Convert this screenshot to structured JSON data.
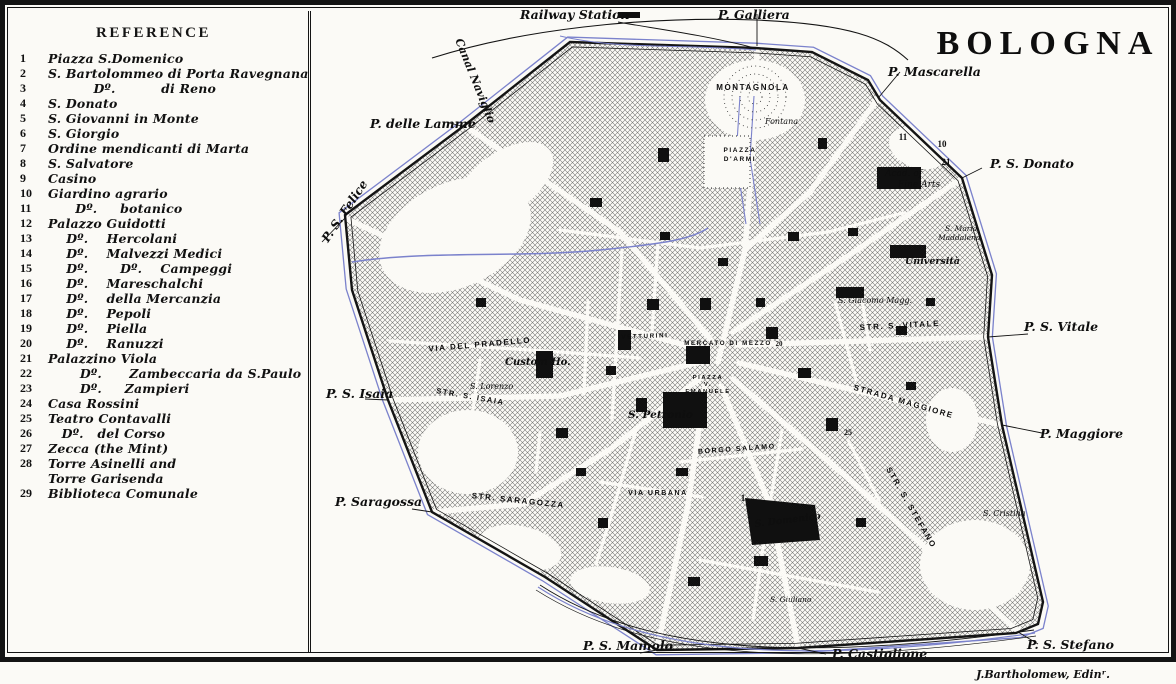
{
  "title": "BOLOGNA",
  "credit": "J.Bartholomew, Edinʳ.",
  "reference": {
    "heading": "REFERENCE",
    "items": [
      {
        "num": "1",
        "text": "Piazza S.Domenico"
      },
      {
        "num": "2",
        "text": "S. Bartolommeo di Porta Ravegnana"
      },
      {
        "num": "3",
        "text": "          Dº.          di Reno"
      },
      {
        "num": "4",
        "text": "S. Donato"
      },
      {
        "num": "5",
        "text": "S. Giovanni in Monte"
      },
      {
        "num": "6",
        "text": "S. Giorgio"
      },
      {
        "num": "7",
        "text": "Ordine mendicanti di Marta"
      },
      {
        "num": "8",
        "text": "S. Salvatore"
      },
      {
        "num": "9",
        "text": "Casino"
      },
      {
        "num": "10",
        "text": "Giardino agrario"
      },
      {
        "num": "11",
        "text": "      Dº.     botanico"
      },
      {
        "num": "12",
        "text": "Palazzo Guidotti"
      },
      {
        "num": "13",
        "text": "    Dº.    Hercolani"
      },
      {
        "num": "14",
        "text": "    Dº.    Malvezzi Medici"
      },
      {
        "num": "15",
        "text": "    Dº.       Dº.    Campeggi"
      },
      {
        "num": "16",
        "text": "    Dº.    Mareschalchi"
      },
      {
        "num": "17",
        "text": "    Dº.    della Mercanzia"
      },
      {
        "num": "18",
        "text": "    Dº.    Pepoli"
      },
      {
        "num": "19",
        "text": "    Dº.    Piella"
      },
      {
        "num": "20",
        "text": "    Dº.    Ranuzzi"
      },
      {
        "num": "21",
        "text": "Palazzino Viola"
      },
      {
        "num": "22",
        "text": "       Dº.      Zambeccaria da S.Paulo"
      },
      {
        "num": "23",
        "text": "       Dº.     Zampieri"
      },
      {
        "num": "24",
        "text": "Casa Rossini"
      },
      {
        "num": "25",
        "text": "Teatro Contavalli"
      },
      {
        "num": "26",
        "text": "   Dº.   del Corso"
      },
      {
        "num": "27",
        "text": "Zecca (the Mint)"
      },
      {
        "num": "28",
        "text": "Torre Asinelli and"
      },
      {
        "num": "",
        "text": "Torre Garisenda"
      },
      {
        "num": "29",
        "text": "Biblioteca Comunale"
      }
    ]
  },
  "map": {
    "colors": {
      "canal": "#7b82cc",
      "ink": "#141414",
      "paper": "#fbfaf6"
    },
    "labels": [
      {
        "t": "BOLOGNA",
        "x": 1048,
        "y": 54,
        "s": 34,
        "c": "title",
        "a": "m"
      },
      {
        "t": "Railway Station",
        "x": 520,
        "y": 19,
        "s": 12.5,
        "c": "gate"
      },
      {
        "t": "P. Galliera",
        "x": 718,
        "y": 19,
        "s": 12.5,
        "c": "gate"
      },
      {
        "t": "P. Mascarella",
        "x": 888,
        "y": 76,
        "s": 12.5,
        "c": "gate"
      },
      {
        "t": "P. S. Donato",
        "x": 990,
        "y": 168,
        "s": 12.5,
        "c": "gate"
      },
      {
        "t": "P. S. Vitale",
        "x": 1024,
        "y": 331,
        "s": 12.5,
        "c": "gate"
      },
      {
        "t": "P. Maggiore",
        "x": 1040,
        "y": 438,
        "s": 12.5,
        "c": "gate"
      },
      {
        "t": "P. S. Stefano",
        "x": 1027,
        "y": 649,
        "s": 12.5,
        "c": "gate"
      },
      {
        "t": "P. Castiglione",
        "x": 832,
        "y": 658,
        "s": 12.5,
        "c": "gate"
      },
      {
        "t": "P. S. Mamolo",
        "x": 583,
        "y": 650,
        "s": 12.5,
        "c": "gate"
      },
      {
        "t": "P. Saragossa",
        "x": 335,
        "y": 506,
        "s": 12.5,
        "c": "gate"
      },
      {
        "t": "P. S. Isaia",
        "x": 326,
        "y": 398,
        "s": 12.5,
        "c": "gate"
      },
      {
        "t": "P. delle Lamme",
        "x": 370,
        "y": 128,
        "s": 12.5,
        "c": "gate"
      },
      {
        "t": "P. S. Felice",
        "x": 328,
        "y": 243,
        "s": 12,
        "c": "gate",
        "r": -56
      },
      {
        "t": "Canal Naviglio",
        "x": 472,
        "y": 82,
        "s": 11,
        "c": "gate",
        "r": 68,
        "a": "m"
      },
      {
        "t": "MONTAGNOLA",
        "x": 753,
        "y": 90,
        "s": 8,
        "c": "street",
        "a": "m"
      },
      {
        "t": "Fontana",
        "x": 765,
        "y": 124,
        "s": 8,
        "c": "poi"
      },
      {
        "t": "PIAZZA",
        "x": 740,
        "y": 152,
        "s": 6.5,
        "c": "street",
        "a": "m"
      },
      {
        "t": "D'ARMI",
        "x": 740,
        "y": 161,
        "s": 6.5,
        "c": "street",
        "a": "m"
      },
      {
        "t": "11",
        "x": 903,
        "y": 140,
        "s": 9,
        "c": "num",
        "a": "m"
      },
      {
        "t": "10",
        "x": 942,
        "y": 147,
        "s": 9,
        "c": "num",
        "a": "m"
      },
      {
        "t": "21",
        "x": 946,
        "y": 165,
        "s": 9,
        "c": "num",
        "a": "m"
      },
      {
        "t": "Acad. of",
        "x": 885,
        "y": 176,
        "s": 9,
        "c": "poi"
      },
      {
        "t": "Fine Arts",
        "x": 898,
        "y": 187,
        "s": 9,
        "c": "poi"
      },
      {
        "t": "S. Maria",
        "x": 945,
        "y": 231,
        "s": 7.5,
        "c": "poi"
      },
      {
        "t": "Maddalena",
        "x": 938,
        "y": 240,
        "s": 7.5,
        "c": "poi"
      },
      {
        "t": "Università",
        "x": 905,
        "y": 264,
        "s": 9.5,
        "c": "poib"
      },
      {
        "t": "S. Giacomo Magg.",
        "x": 838,
        "y": 303,
        "s": 8,
        "c": "poi"
      },
      {
        "t": "STR. S. VITALE",
        "x": 900,
        "y": 328,
        "s": 8,
        "c": "street",
        "a": "m",
        "r": -3
      },
      {
        "t": "STRADA MAGGIORE",
        "x": 903,
        "y": 404,
        "s": 8,
        "c": "street",
        "a": "m",
        "r": 16
      },
      {
        "t": "STR. S. STEFANO",
        "x": 909,
        "y": 509,
        "s": 8,
        "c": "street",
        "a": "m",
        "r": 60
      },
      {
        "t": "S. Cristina",
        "x": 983,
        "y": 516,
        "s": 8,
        "c": "poi"
      },
      {
        "t": "25",
        "x": 848,
        "y": 435,
        "s": 8,
        "c": "num",
        "a": "m"
      },
      {
        "t": "MERCATO DI MEZZO",
        "x": 728,
        "y": 345,
        "s": 6.2,
        "c": "street",
        "a": "m"
      },
      {
        "t": "20",
        "x": 779,
        "y": 346,
        "s": 7,
        "c": "num",
        "a": "m"
      },
      {
        "t": "VETTURINI",
        "x": 645,
        "y": 338,
        "s": 6.2,
        "c": "street",
        "a": "m",
        "r": -2
      },
      {
        "t": "PIAZZA",
        "x": 708,
        "y": 379,
        "s": 5.8,
        "c": "street",
        "a": "m"
      },
      {
        "t": "V.",
        "x": 708,
        "y": 386,
        "s": 5.8,
        "c": "street",
        "a": "m"
      },
      {
        "t": "EMANUELE",
        "x": 708,
        "y": 393,
        "s": 5.8,
        "c": "street",
        "a": "m"
      },
      {
        "t": "S. Petronio",
        "x": 628,
        "y": 418,
        "s": 10.5,
        "c": "poib"
      },
      {
        "t": "Custom Ho.",
        "x": 505,
        "y": 365,
        "s": 10,
        "c": "poib"
      },
      {
        "t": "S. Lorenzo",
        "x": 470,
        "y": 389,
        "s": 8,
        "c": "poi"
      },
      {
        "t": "VIA DEL PRADELLO",
        "x": 480,
        "y": 347,
        "s": 8,
        "c": "street",
        "a": "m",
        "r": -5
      },
      {
        "t": "STR. S. ISAIA",
        "x": 470,
        "y": 399,
        "s": 7.5,
        "c": "street",
        "a": "m",
        "r": 10
      },
      {
        "t": "STR. SARAGOZZA",
        "x": 518,
        "y": 503,
        "s": 8,
        "c": "street",
        "a": "m",
        "r": 6
      },
      {
        "t": "VIA URBANA",
        "x": 658,
        "y": 495,
        "s": 7,
        "c": "street",
        "a": "m"
      },
      {
        "t": "BORGO SALAMO",
        "x": 737,
        "y": 451,
        "s": 7,
        "c": "street",
        "a": "m",
        "r": -4
      },
      {
        "t": "1",
        "x": 743,
        "y": 501,
        "s": 9,
        "c": "num",
        "a": "m"
      },
      {
        "t": "S. Domenico",
        "x": 755,
        "y": 527,
        "s": 9.5,
        "c": "poib",
        "r": -7
      },
      {
        "t": "S. Giuliano",
        "x": 770,
        "y": 602,
        "s": 7.5,
        "c": "poi"
      }
    ]
  }
}
